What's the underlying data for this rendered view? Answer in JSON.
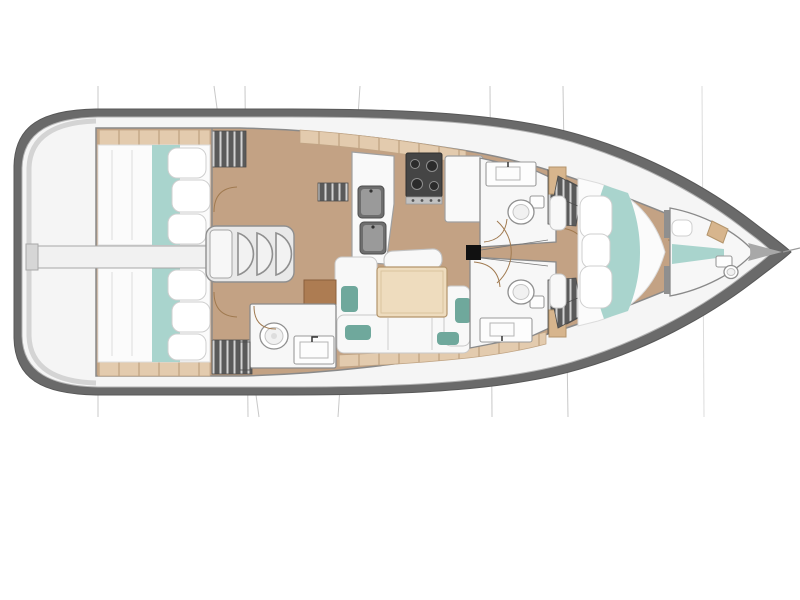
{
  "document": {
    "kind": "sailing-yacht-interior-floor-plan",
    "orientation": "bow-right",
    "background": "#ffffff"
  },
  "colors": {
    "hullOutline": "#6a6a6a",
    "deck": "#f5f5f5",
    "wall": "#8a8a8a",
    "floor": "#c3a284",
    "shelf": "#e3cbae",
    "shelfSeam": "#c6a988",
    "wood": "#ad7c52",
    "mattress": "#fbfbfb",
    "teal": "#a9d4cd",
    "tealCushion": "#6fa89c",
    "lockerDark": "#5a5a5a",
    "lockerStripe": "#d2d2d2",
    "stove": "#454545",
    "rig": "#c8c8c8",
    "doorArc": "#a07a50",
    "mast": "#111111"
  },
  "regions": [
    {
      "id": "rigging-lines",
      "label": "rigging lines"
    },
    {
      "id": "stern-platform",
      "label": "stern platform"
    },
    {
      "id": "aft-cabin-top",
      "label": "aft double cabin"
    },
    {
      "id": "aft-cabin-bottom",
      "label": "aft double cabin"
    },
    {
      "id": "engine-access-corridor",
      "label": "engine access corridor"
    },
    {
      "id": "companionway-stairs",
      "label": "companionway stairs"
    },
    {
      "id": "galley",
      "label": "galley with double sink, stove, fridge"
    },
    {
      "id": "salon",
      "label": "salon with table and U-sofa"
    },
    {
      "id": "head-bottom-left",
      "label": "head with toilet and sink"
    },
    {
      "id": "head-top-right",
      "label": "head with toilet and sink"
    },
    {
      "id": "head-bottom-right",
      "label": "head with toilet and sink"
    },
    {
      "id": "mast",
      "label": "mast"
    },
    {
      "id": "forward-cabin",
      "label": "forward double cabin"
    },
    {
      "id": "forepeak-cabin",
      "label": "forepeak berth with toilet"
    },
    {
      "id": "bow",
      "label": "bow with forestay"
    }
  ]
}
